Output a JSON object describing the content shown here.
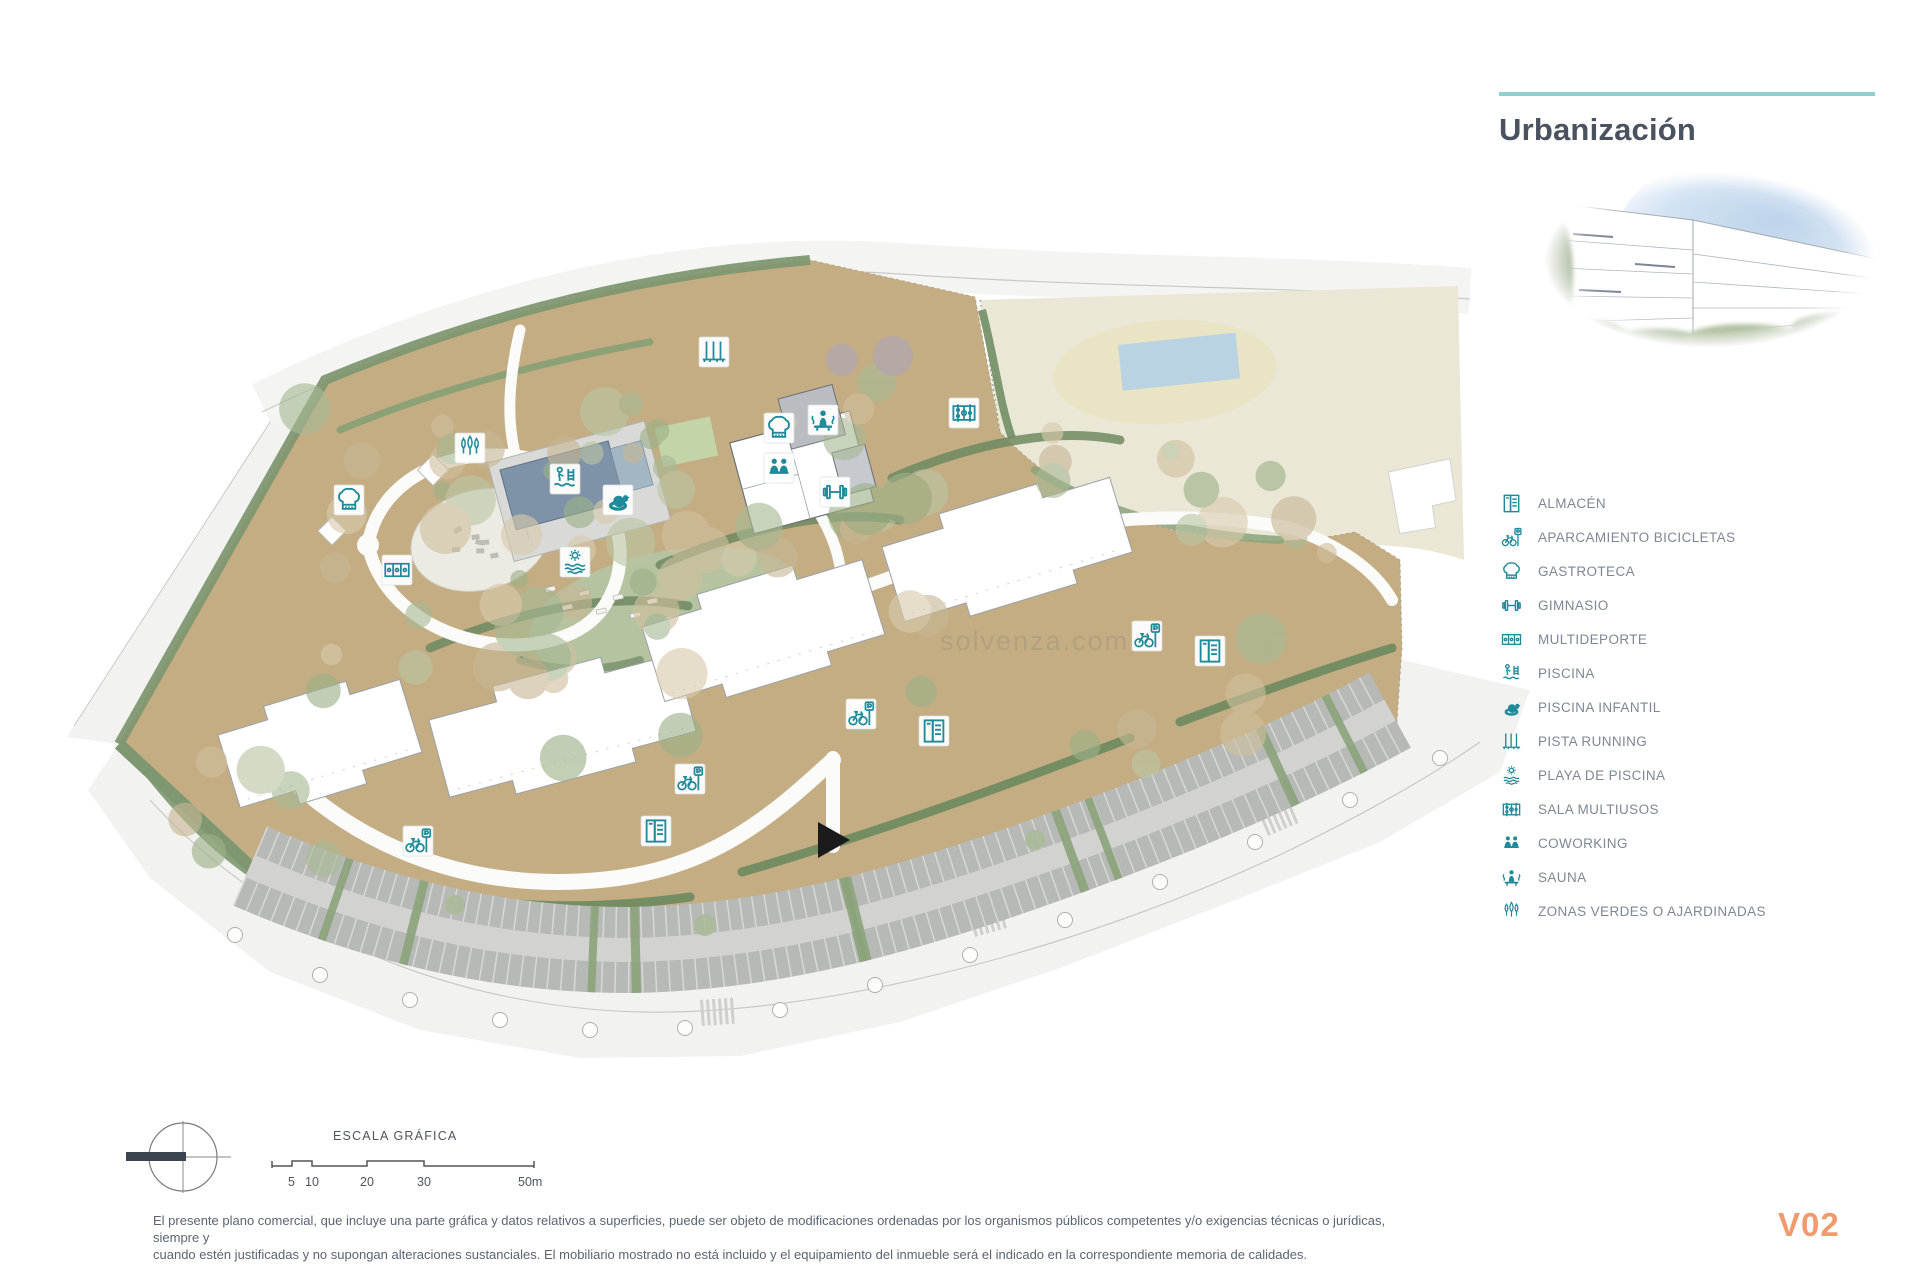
{
  "title": "Urbanización",
  "legend": {
    "items": [
      {
        "icon": "almacen-icon",
        "label": "ALMACÉN"
      },
      {
        "icon": "aparcamiento-bicicletas-icon",
        "label": "APARCAMIENTO BICICLETAS"
      },
      {
        "icon": "gastroteca-icon",
        "label": "GASTROTECA"
      },
      {
        "icon": "gimnasio-icon",
        "label": "GIMNASIO"
      },
      {
        "icon": "multideporte-icon",
        "label": "MULTIDEPORTE"
      },
      {
        "icon": "piscina-icon",
        "label": "PISCINA"
      },
      {
        "icon": "piscina-infantil-icon",
        "label": "PISCINA INFANTIL"
      },
      {
        "icon": "pista-running-icon",
        "label": "PISTA RUNNING"
      },
      {
        "icon": "playa-de-piscina-icon",
        "label": "PLAYA DE PISCINA"
      },
      {
        "icon": "sala-multiusos-icon",
        "label": "SALA MULTIUSOS"
      },
      {
        "icon": "coworking-icon",
        "label": "COWORKING"
      },
      {
        "icon": "sauna-icon",
        "label": "SAUNA"
      },
      {
        "icon": "zonas-verdes-icon",
        "label": "ZONAS VERDES O AJARDINADAS"
      }
    ]
  },
  "scale_bar": {
    "title": "ESCALA GRÁFICA",
    "ticks": [
      "5",
      "10",
      "20",
      "30",
      "50m"
    ]
  },
  "footer": {
    "line1": "El presente plano comercial, que incluye una parte gráfica y datos relativos a superficies, puede ser objeto de modificaciones ordenadas por los organismos públicos competentes y/o exigencias técnicas o jurídicas, siempre y",
    "line2": "cuando estén justificadas y no supongan alteraciones sustanciales. El mobiliario mostrado no está incluido y el equipamiento del inmueble será el indicado en la correspondiente memoria de calidades.",
    "version": "V02"
  },
  "watermark": "solvenza.com",
  "colors": {
    "accent_teal": "#1f8a99",
    "rule_teal": "#8fcfce",
    "title_color": "#49525e",
    "version_orange": "#f09a6e",
    "site_tan": "#c4ad83",
    "green_dark": "#7d9770",
    "parking_gray": "#b7b9b6",
    "pool_blue": "#7f93a8",
    "neighbor_beige": "#ebe7d7"
  }
}
